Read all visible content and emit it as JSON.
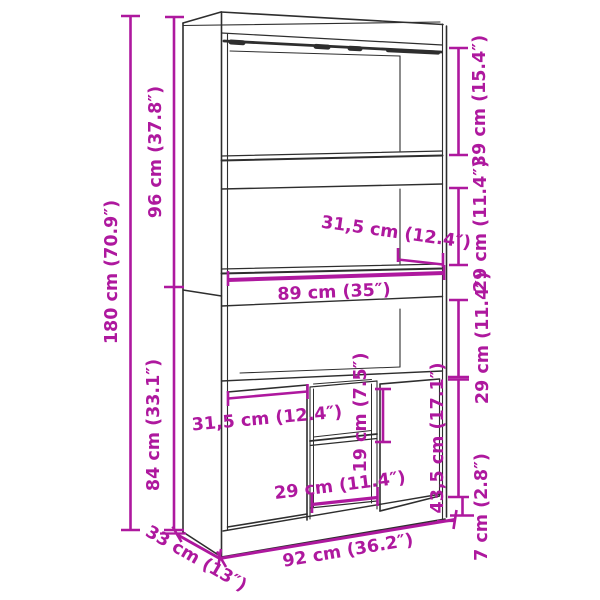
{
  "title": "Highboard dimension diagram",
  "colors": {
    "accent": "#ae189e",
    "line": "#2e2e2e",
    "background": "#ffffff"
  },
  "dimensions": {
    "total_height": "180 cm (70.9″)",
    "upper_section_height": "96 cm (37.8″)",
    "lower_section_height": "84 cm (33.1″)",
    "top_compartment_height": "39 cm (15.4″)",
    "upper_compartment_height": "29 cm (11.4″)",
    "middle_compartment_height": "29 cm (11.4″)",
    "door_height": "43,5 cm (17.1″)",
    "plinth_height": "7 cm (2.8″)",
    "upper_depth": "31,5 cm (12.4″)",
    "worktop_width": "89 cm (35″)",
    "door_width": "31,5 cm (12.4″)",
    "niche_shelf_clearance": "19 cm (7.5″)",
    "niche_width": "29 cm (11.4″)",
    "depth": "33 cm (13″)",
    "total_width": "92 cm (36.2″)"
  }
}
